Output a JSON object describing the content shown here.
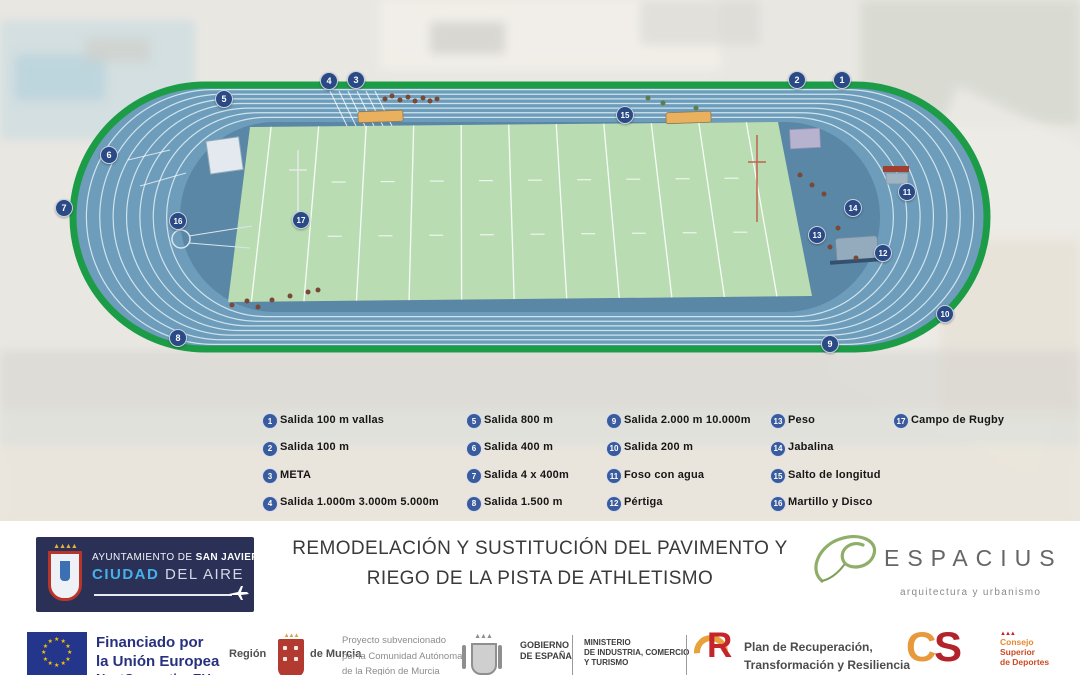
{
  "colors": {
    "track_blue": "#6d9dba",
    "infield_blue": "#5a87a6",
    "border_green": "#1d9c48",
    "field_green": "#b9dcb3",
    "lane_line": "#cfe3ee",
    "badge_navy": "#2a4a86",
    "municipal_navy": "#2b3057",
    "eu_blue": "#24358c",
    "accent_cyan": "#45b1e8",
    "espacius_green": "#8fae68",
    "prtr_red": "#c6242c",
    "csd_orange": "#e8993c"
  },
  "track": {
    "markers": [
      {
        "n": "1",
        "x": 841,
        "y": 79
      },
      {
        "n": "2",
        "x": 796,
        "y": 79
      },
      {
        "n": "3",
        "x": 355,
        "y": 79
      },
      {
        "n": "4",
        "x": 328,
        "y": 80
      },
      {
        "n": "5",
        "x": 223,
        "y": 98
      },
      {
        "n": "6",
        "x": 108,
        "y": 154
      },
      {
        "n": "7",
        "x": 63,
        "y": 207
      },
      {
        "n": "8",
        "x": 177,
        "y": 337
      },
      {
        "n": "9",
        "x": 829,
        "y": 343
      },
      {
        "n": "10",
        "x": 944,
        "y": 313
      },
      {
        "n": "11",
        "x": 906,
        "y": 191
      },
      {
        "n": "12",
        "x": 882,
        "y": 252
      },
      {
        "n": "13",
        "x": 816,
        "y": 234
      },
      {
        "n": "14",
        "x": 852,
        "y": 207
      },
      {
        "n": "15",
        "x": 624,
        "y": 114
      },
      {
        "n": "16",
        "x": 177,
        "y": 220
      },
      {
        "n": "17",
        "x": 300,
        "y": 219
      }
    ]
  },
  "legend": {
    "items": [
      {
        "n": "1",
        "label": "Salida 100 m vallas"
      },
      {
        "n": "2",
        "label": "Salida 100 m"
      },
      {
        "n": "3",
        "label": "META"
      },
      {
        "n": "4",
        "label": "Salida 1.000m 3.000m 5.000m"
      },
      {
        "n": "5",
        "label": "Salida 800 m"
      },
      {
        "n": "6",
        "label": "Salida 400 m"
      },
      {
        "n": "7",
        "label": "Salida 4 x 400m"
      },
      {
        "n": "8",
        "label": "Salida 1.500 m"
      },
      {
        "n": "9",
        "label": "Salida 2.000 m 10.000m"
      },
      {
        "n": "10",
        "label": "Salida 200 m"
      },
      {
        "n": "11",
        "label": "Foso con agua"
      },
      {
        "n": "12",
        "label": "Pértiga"
      },
      {
        "n": "13",
        "label": "Peso"
      },
      {
        "n": "14",
        "label": "Jabalina"
      },
      {
        "n": "15",
        "label": "Salto de longitud"
      },
      {
        "n": "16",
        "label": "Martillo y Disco"
      },
      {
        "n": "17",
        "label": "Campo de Rugby"
      }
    ]
  },
  "footer": {
    "municipality": {
      "line1_normal": "AYUNTAMIENTO DE ",
      "line1_bold": "SAN JAVIER",
      "line2_accent": "CIUDAD",
      "line2_rest": " DEL AIRE"
    },
    "title_line1": "REMODELACIÓN Y SUSTITUCIÓN DEL PAVIMENTO Y",
    "title_line2": "RIEGO DE LA PISTA DE ATHLETISMO",
    "studio": {
      "name": "ESPACIUS",
      "tagline": "arquitectura y urbanismo"
    }
  },
  "funding": {
    "eu": {
      "line1": "Financiado por",
      "line2": "la Unión Europea",
      "line3": "NextGenerationEU"
    },
    "murcia": {
      "left": "Región",
      "right": "de Murcia"
    },
    "subsidy": [
      "Proyecto subvencionado",
      "por la Comunidad Autónoma",
      "de la Región de Murcia"
    ],
    "gobierno": [
      "GOBIERNO",
      "DE ESPAÑA"
    ],
    "ministerio": [
      "MINISTERIO",
      "DE INDUSTRIA, COMERCIO",
      "Y TURISMO"
    ],
    "prtr": [
      "Plan de Recuperación,",
      "Transformación y Resiliencia"
    ],
    "csd": [
      "Consejo",
      "Superior",
      "de Deportes"
    ]
  }
}
